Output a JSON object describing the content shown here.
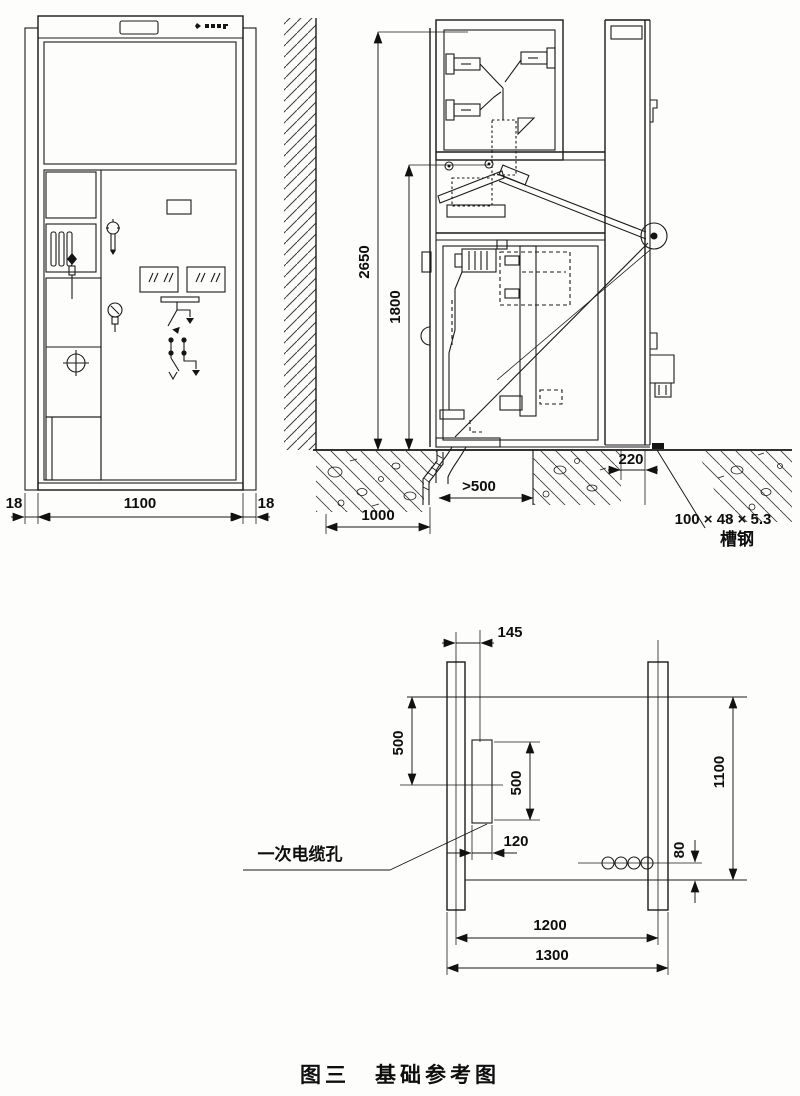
{
  "figure": {
    "caption": "图三　基础参考图"
  },
  "front_view": {
    "dim_flange_left": "18",
    "dim_cabinet_width": "1100",
    "dim_flange_right": "18"
  },
  "side_view": {
    "dim_total_height": "2650",
    "dim_lower_section_height": "1800",
    "dim_foundation_apron": "1000",
    "dim_cable_trench_min_width": ">500",
    "dim_rear_clearance": "220",
    "channel_steel_spec": "100 × 48 × 5.3",
    "channel_steel_name": "槽钢"
  },
  "plan_view": {
    "dim_rail_to_hole_center": "145",
    "dim_front_to_hole_center": "500",
    "dim_hole_length": "500",
    "dim_foundation_depth": "1100",
    "dim_hole_width": "120",
    "dim_bolt_offset": "80",
    "dim_rail_centers": "1200",
    "dim_overall_width": "1300",
    "primary_cable_hole_label": "一次电缆孔"
  }
}
